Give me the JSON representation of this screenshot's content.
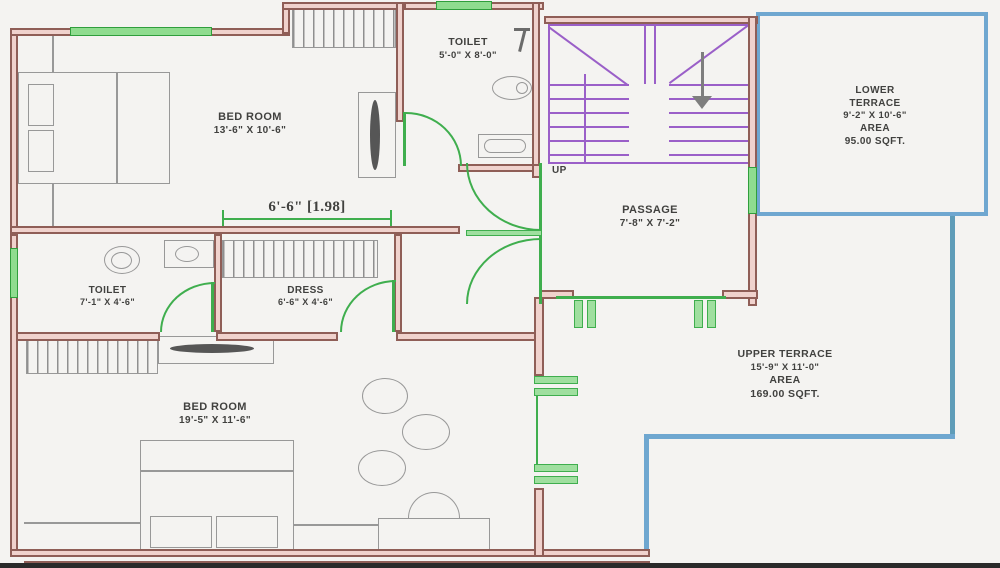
{
  "plan": {
    "rooms": {
      "bedroom1": {
        "name": "BED ROOM",
        "dims": "13'-6\" X 10'-6\""
      },
      "toilet1": {
        "name": "TOILET",
        "dims": "5'-0\" X 8'-0\""
      },
      "lower_terrace": {
        "name_line1": "LOWER",
        "name_line2": "TERRACE",
        "dims": "9'-2\" X 10'-6\"",
        "area_label": "AREA",
        "area_value": "95.00 SQFT."
      },
      "passage": {
        "name": "PASSAGE",
        "dims": "7'-8\" X 7'-2\""
      },
      "toilet2": {
        "name": "TOILET",
        "dims": "7'-1\" X 4'-6\""
      },
      "dress": {
        "name": "DRESS",
        "dims": "6'-6\" X 4'-6\""
      },
      "bedroom2": {
        "name": "BED ROOM",
        "dims": "19'-5\" X 11'-6\""
      },
      "upper_terrace": {
        "name": "UPPER TERRACE",
        "dims": "15'-9\" X 11'-0\"",
        "area_label": "AREA",
        "area_value": "169.00 SQFT."
      }
    },
    "annotations": {
      "door_width_dimension": "6'-6\" [1.98]",
      "stair_direction": "UP"
    },
    "colors": {
      "wall_outline": "#8f5e57",
      "wall_fill": "#f0d2cd",
      "window_green": "#4cb84c",
      "door_green": "#3fae4e",
      "stair_purple": "#9a5fc8",
      "terrace_blue": "#6fa7d0",
      "terrace_teal": "#5f9cb8",
      "furniture_gray": "#8f8f8f",
      "text_color": "#41413f",
      "background": "#f4f3f1"
    }
  }
}
